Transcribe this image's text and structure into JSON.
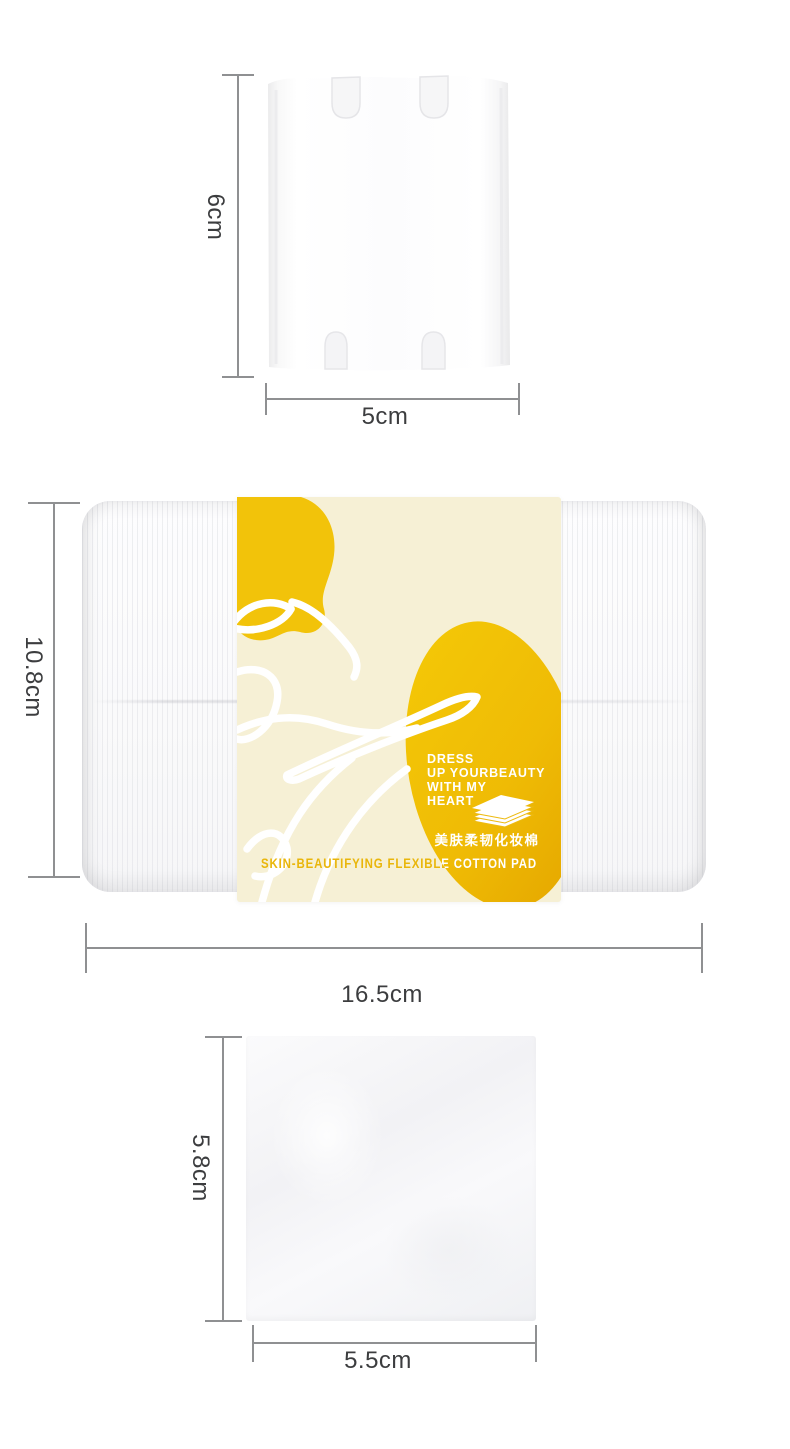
{
  "colors": {
    "yellow": "#F0C10E",
    "yellow_deep": "#E7AC00",
    "cream": "#F6F0D5",
    "gold_text": "#E9B60B",
    "measure_line": "#8F9092",
    "label_text": "#3C3D3F"
  },
  "top_section": {
    "height_label": "6cm",
    "width_label": "5cm"
  },
  "middle_section": {
    "height_label": "10.8cm",
    "width_label": "16.5cm",
    "slogan_lines": [
      "DRESS",
      "UP YOURBEAUTY",
      "WITH MY",
      "HEART"
    ],
    "chinese_name": "美肤柔韧化妆棉",
    "band_title": "SKIN-BEAUTIFYING FLEXIBLE COTTON PAD"
  },
  "bottom_section": {
    "height_label": "5.8cm",
    "width_label": "5.5cm"
  }
}
